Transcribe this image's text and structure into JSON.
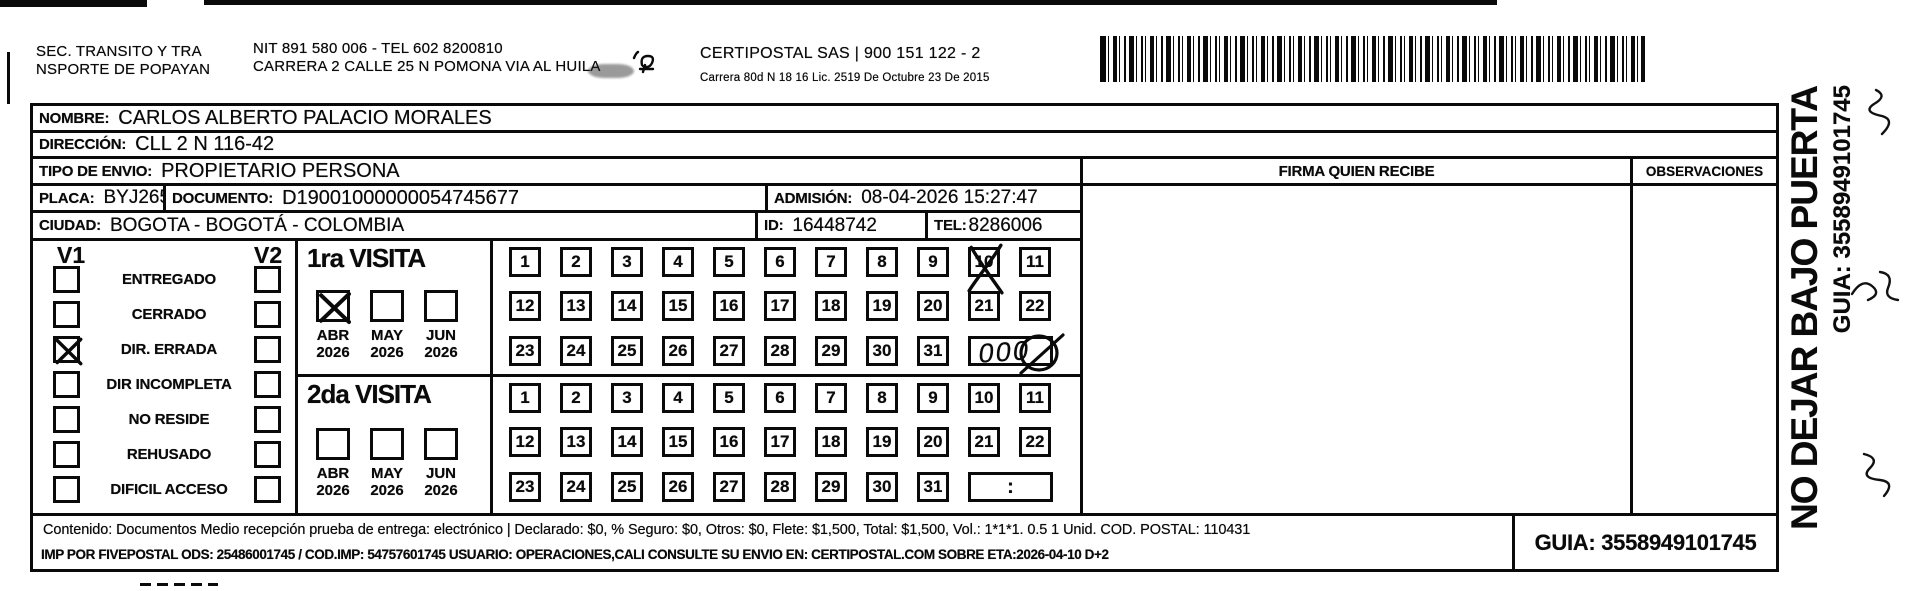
{
  "page": {
    "bg": "#ffffff",
    "ink": "#0a0a0a"
  },
  "header": {
    "sender": {
      "line1": "SEC. TRANSITO Y TRA",
      "line2": "NSPORTE DE POPAYAN"
    },
    "origin": {
      "line1": "NIT 891 580 006 - TEL 602 8200810",
      "line2": "CARRERA 2 CALLE 25 N POMONA VIA AL HUILA"
    },
    "carrier": {
      "line1": "CERTIPOSTAL SAS | 900 151 122 - 2",
      "line2": "Carrera 80d N 18 16  Lic. 2519 De Octubre 23 De 2015"
    }
  },
  "fields": {
    "nombre": {
      "label": "NOMBRE:",
      "value": "CARLOS ALBERTO PALACIO MORALES"
    },
    "direccion": {
      "label": "DIRECCIÓN:",
      "value": "CLL 2 N 116-42"
    },
    "tipo_envio": {
      "label": "TIPO DE ENVIO:",
      "value": "PROPIETARIO PERSONA"
    },
    "placa": {
      "label": "PLACA:",
      "value": "BYJ265"
    },
    "documento": {
      "label": "DOCUMENTO:",
      "value": "D19001000000054745677"
    },
    "admision": {
      "label": "ADMISIÓN:",
      "value": "08-04-2026 15:27:47"
    },
    "ciudad": {
      "label": "CIUDAD:",
      "value": "BOGOTA - BOGOTÁ - COLOMBIA"
    },
    "id": {
      "label": "ID:",
      "value": "16448742"
    },
    "tel": {
      "label": "TEL:",
      "value": "8286006"
    }
  },
  "columns": {
    "firma": "FIRMA QUIEN RECIBE",
    "observaciones": "OBSERVACIONES"
  },
  "status_panel": {
    "v1": "V1",
    "v2": "V2",
    "items": [
      {
        "label": "ENTREGADO",
        "v1_checked": false,
        "v2_checked": false
      },
      {
        "label": "CERRADO",
        "v1_checked": false,
        "v2_checked": false
      },
      {
        "label": "DIR. ERRADA",
        "v1_checked": true,
        "v2_checked": false
      },
      {
        "label": "DIR INCOMPLETA",
        "v1_checked": false,
        "v2_checked": false
      },
      {
        "label": "NO RESIDE",
        "v1_checked": false,
        "v2_checked": false
      },
      {
        "label": "REHUSADO",
        "v1_checked": false,
        "v2_checked": false
      },
      {
        "label": "DIFICIL ACCESO",
        "v1_checked": false,
        "v2_checked": false
      }
    ]
  },
  "visits": [
    {
      "title": "1ra VISITA",
      "months": [
        {
          "month": "ABR",
          "year": "2026",
          "checked": true
        },
        {
          "month": "MAY",
          "year": "2026",
          "checked": false
        },
        {
          "month": "JUN",
          "year": "2026",
          "checked": false
        }
      ],
      "day_rows": [
        [
          1,
          2,
          3,
          4,
          5,
          6,
          7,
          8,
          9,
          10,
          11
        ],
        [
          12,
          13,
          14,
          15,
          16,
          17,
          18,
          19,
          20,
          21,
          22
        ],
        [
          23,
          24,
          25,
          26,
          27,
          28,
          29,
          30,
          31
        ]
      ],
      "crossed_day": 10,
      "time_box": {
        "style": "handwriting",
        "text": "000"
      }
    },
    {
      "title": "2da VISITA",
      "months": [
        {
          "month": "ABR",
          "year": "2026",
          "checked": false
        },
        {
          "month": "MAY",
          "year": "2026",
          "checked": false
        },
        {
          "month": "JUN",
          "year": "2026",
          "checked": false
        }
      ],
      "day_rows": [
        [
          1,
          2,
          3,
          4,
          5,
          6,
          7,
          8,
          9,
          10,
          11
        ],
        [
          12,
          13,
          14,
          15,
          16,
          17,
          18,
          19,
          20,
          21,
          22
        ],
        [
          23,
          24,
          25,
          26,
          27,
          28,
          29,
          30,
          31
        ]
      ],
      "crossed_day": null,
      "time_box": {
        "style": "plain",
        "text": ":"
      }
    }
  ],
  "footer": {
    "line1": "Contenido: Documentos Medio recepción prueba de entrega: electrónico | Declarado: $0, % Seguro: $0, Otros: $0, Flete: $1,500, Total: $1,500, Vol.: 1*1*1. 0.5  1 Unid. COD. POSTAL: 110431",
    "line2": "IMP POR FIVEPOSTAL ODS: 25486001745 / COD.IMP: 54757601745 USUARIO: OPERACIONES,CALI CONSULTE SU ENVIO EN: CERTIPOSTAL.COM SOBRE ETA:2026-04-10 D+2",
    "guia": "GUIA: 3558949101745"
  },
  "sidebar": {
    "warning": "NO DEJAR BAJO PUERTA",
    "guia": "GUIA: 3558949101745"
  }
}
